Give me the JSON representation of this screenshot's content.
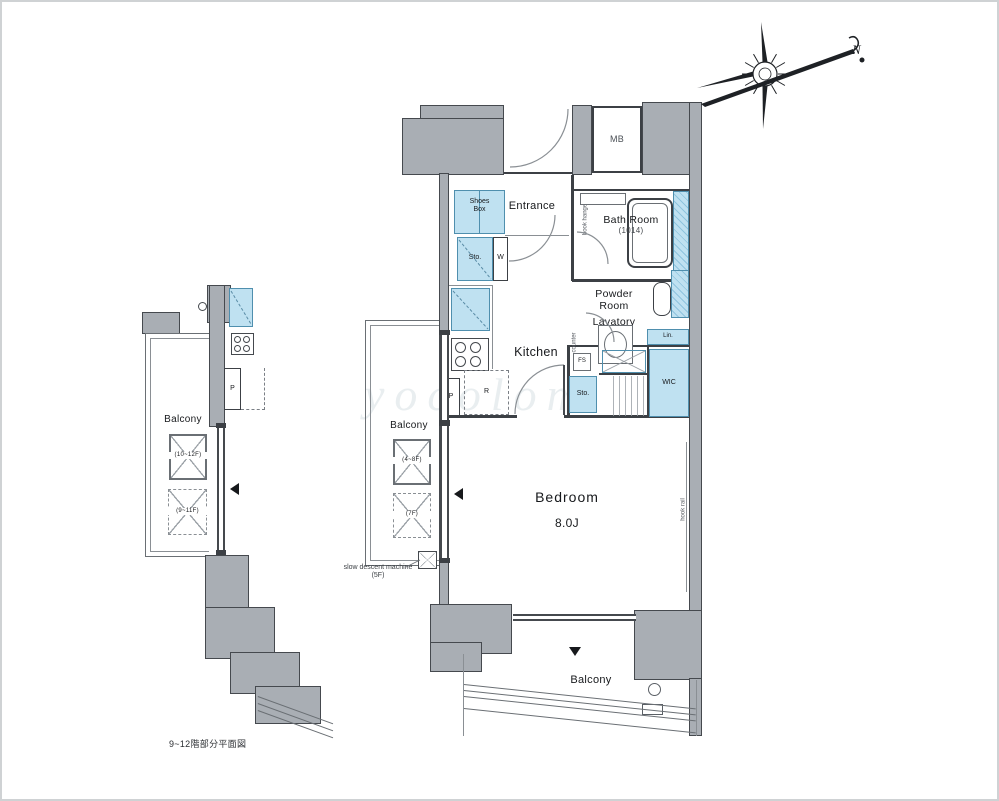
{
  "colors": {
    "wall_fill": "#a9aeb4",
    "fixture_fill": "#bfe1f1",
    "fixture_border": "#4f8fae",
    "line": "#3c4045"
  },
  "compass": {
    "north_label": "N"
  },
  "plan": {
    "caption": "9~12階部分平面図",
    "watermark": "yocolom",
    "main": {
      "mb": "MB",
      "entrance": "Entrance",
      "entrance_note": "hook hanger",
      "shoes_box": "Shoes\nBox",
      "bath": "Bath Room",
      "bath_size": "(1014)",
      "powder": "Powder\nRoom",
      "lavatory": "Lavatory",
      "counter_note": "counter",
      "kitchen": "Kitchen",
      "bedroom": "Bedroom",
      "bedroom_size": "8.0J",
      "hook_rail": "hook rail",
      "balcony": "Balcony",
      "sto_hall": "Sto.",
      "w": "W",
      "r": "R",
      "p": "P",
      "fs": "FS",
      "lin": "Lin.",
      "wic": "WIC",
      "sto_bedroom": "Sto."
    },
    "side_balcony": {
      "label": "Balcony",
      "hatch_upper": "(4~8F)",
      "hatch_lower": "(7F)",
      "note": "slow descent machine\n(5F)"
    },
    "left_fragment": {
      "balcony": "Balcony",
      "hatch_upper": "(10~12F)",
      "hatch_lower": "(9~11F)",
      "p": "P"
    }
  }
}
